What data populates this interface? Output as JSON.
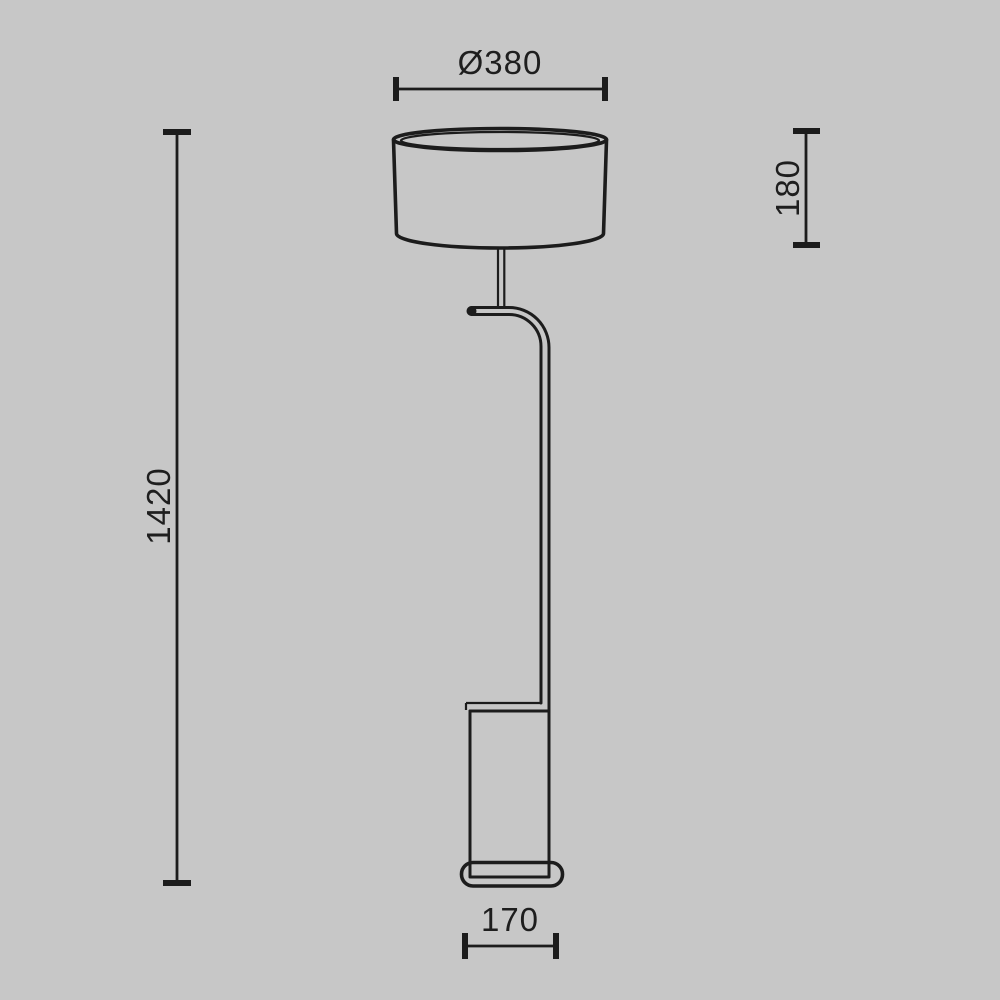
{
  "drawing": {
    "background_color": "#c7c7c7",
    "line_color": "#1c1c1c",
    "label_color": "#1e1e1e"
  },
  "dimensions": {
    "shade_diameter_label": "Ø380",
    "shade_height_label": "180",
    "total_height_label": "1420",
    "base_width_label": "170"
  }
}
